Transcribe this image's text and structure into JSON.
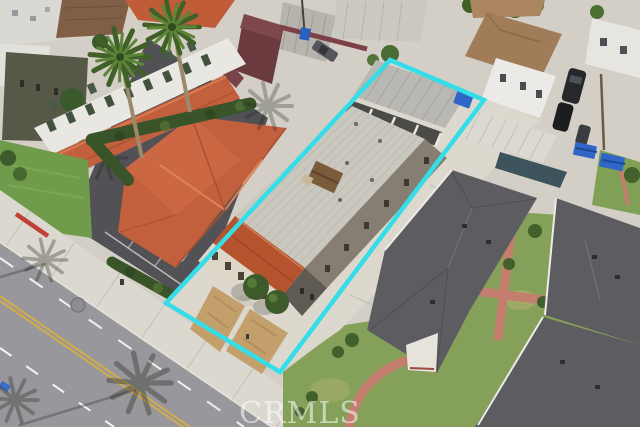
{
  "watermark": {
    "text": "CRMLS",
    "color": "#ffffff",
    "opacity": "0.55"
  },
  "property_outline": {
    "points": "390,60 484,100 280,372 166,303",
    "color": "#35dde8",
    "stroke_width": "4.5"
  },
  "palette": {
    "concrete": "#d3cfc6",
    "sidewalk": "#dbd8cf",
    "road": "#98979c",
    "yellow_line": "#d2ab4b",
    "red_curb": "#c04038",
    "asphalt_lot": "#515156",
    "white_building": "#e9e7e1",
    "tile_roof": "#c25f3d",
    "tile_roof_bright": "#c05c38",
    "subject_flat_roof": "#cac7bf",
    "subject_lot_concrete": "#dcd8ce",
    "carport_roof": "#bab8b2",
    "warehouse_roof": "#b7b4ae",
    "dark_shingle": "#5d5d61",
    "lawn": "#85a159",
    "lawn_bright": "#6f9b4a",
    "hedge": "#3a5429",
    "brick_path": "#c47e6e",
    "dirt_patch": "#c3a06b",
    "dumpster_blue": "#2f66c8",
    "white_carport": "#dcd9d2",
    "maroon_building": "#6b3a3f",
    "tan_roof": "#a07c58"
  }
}
